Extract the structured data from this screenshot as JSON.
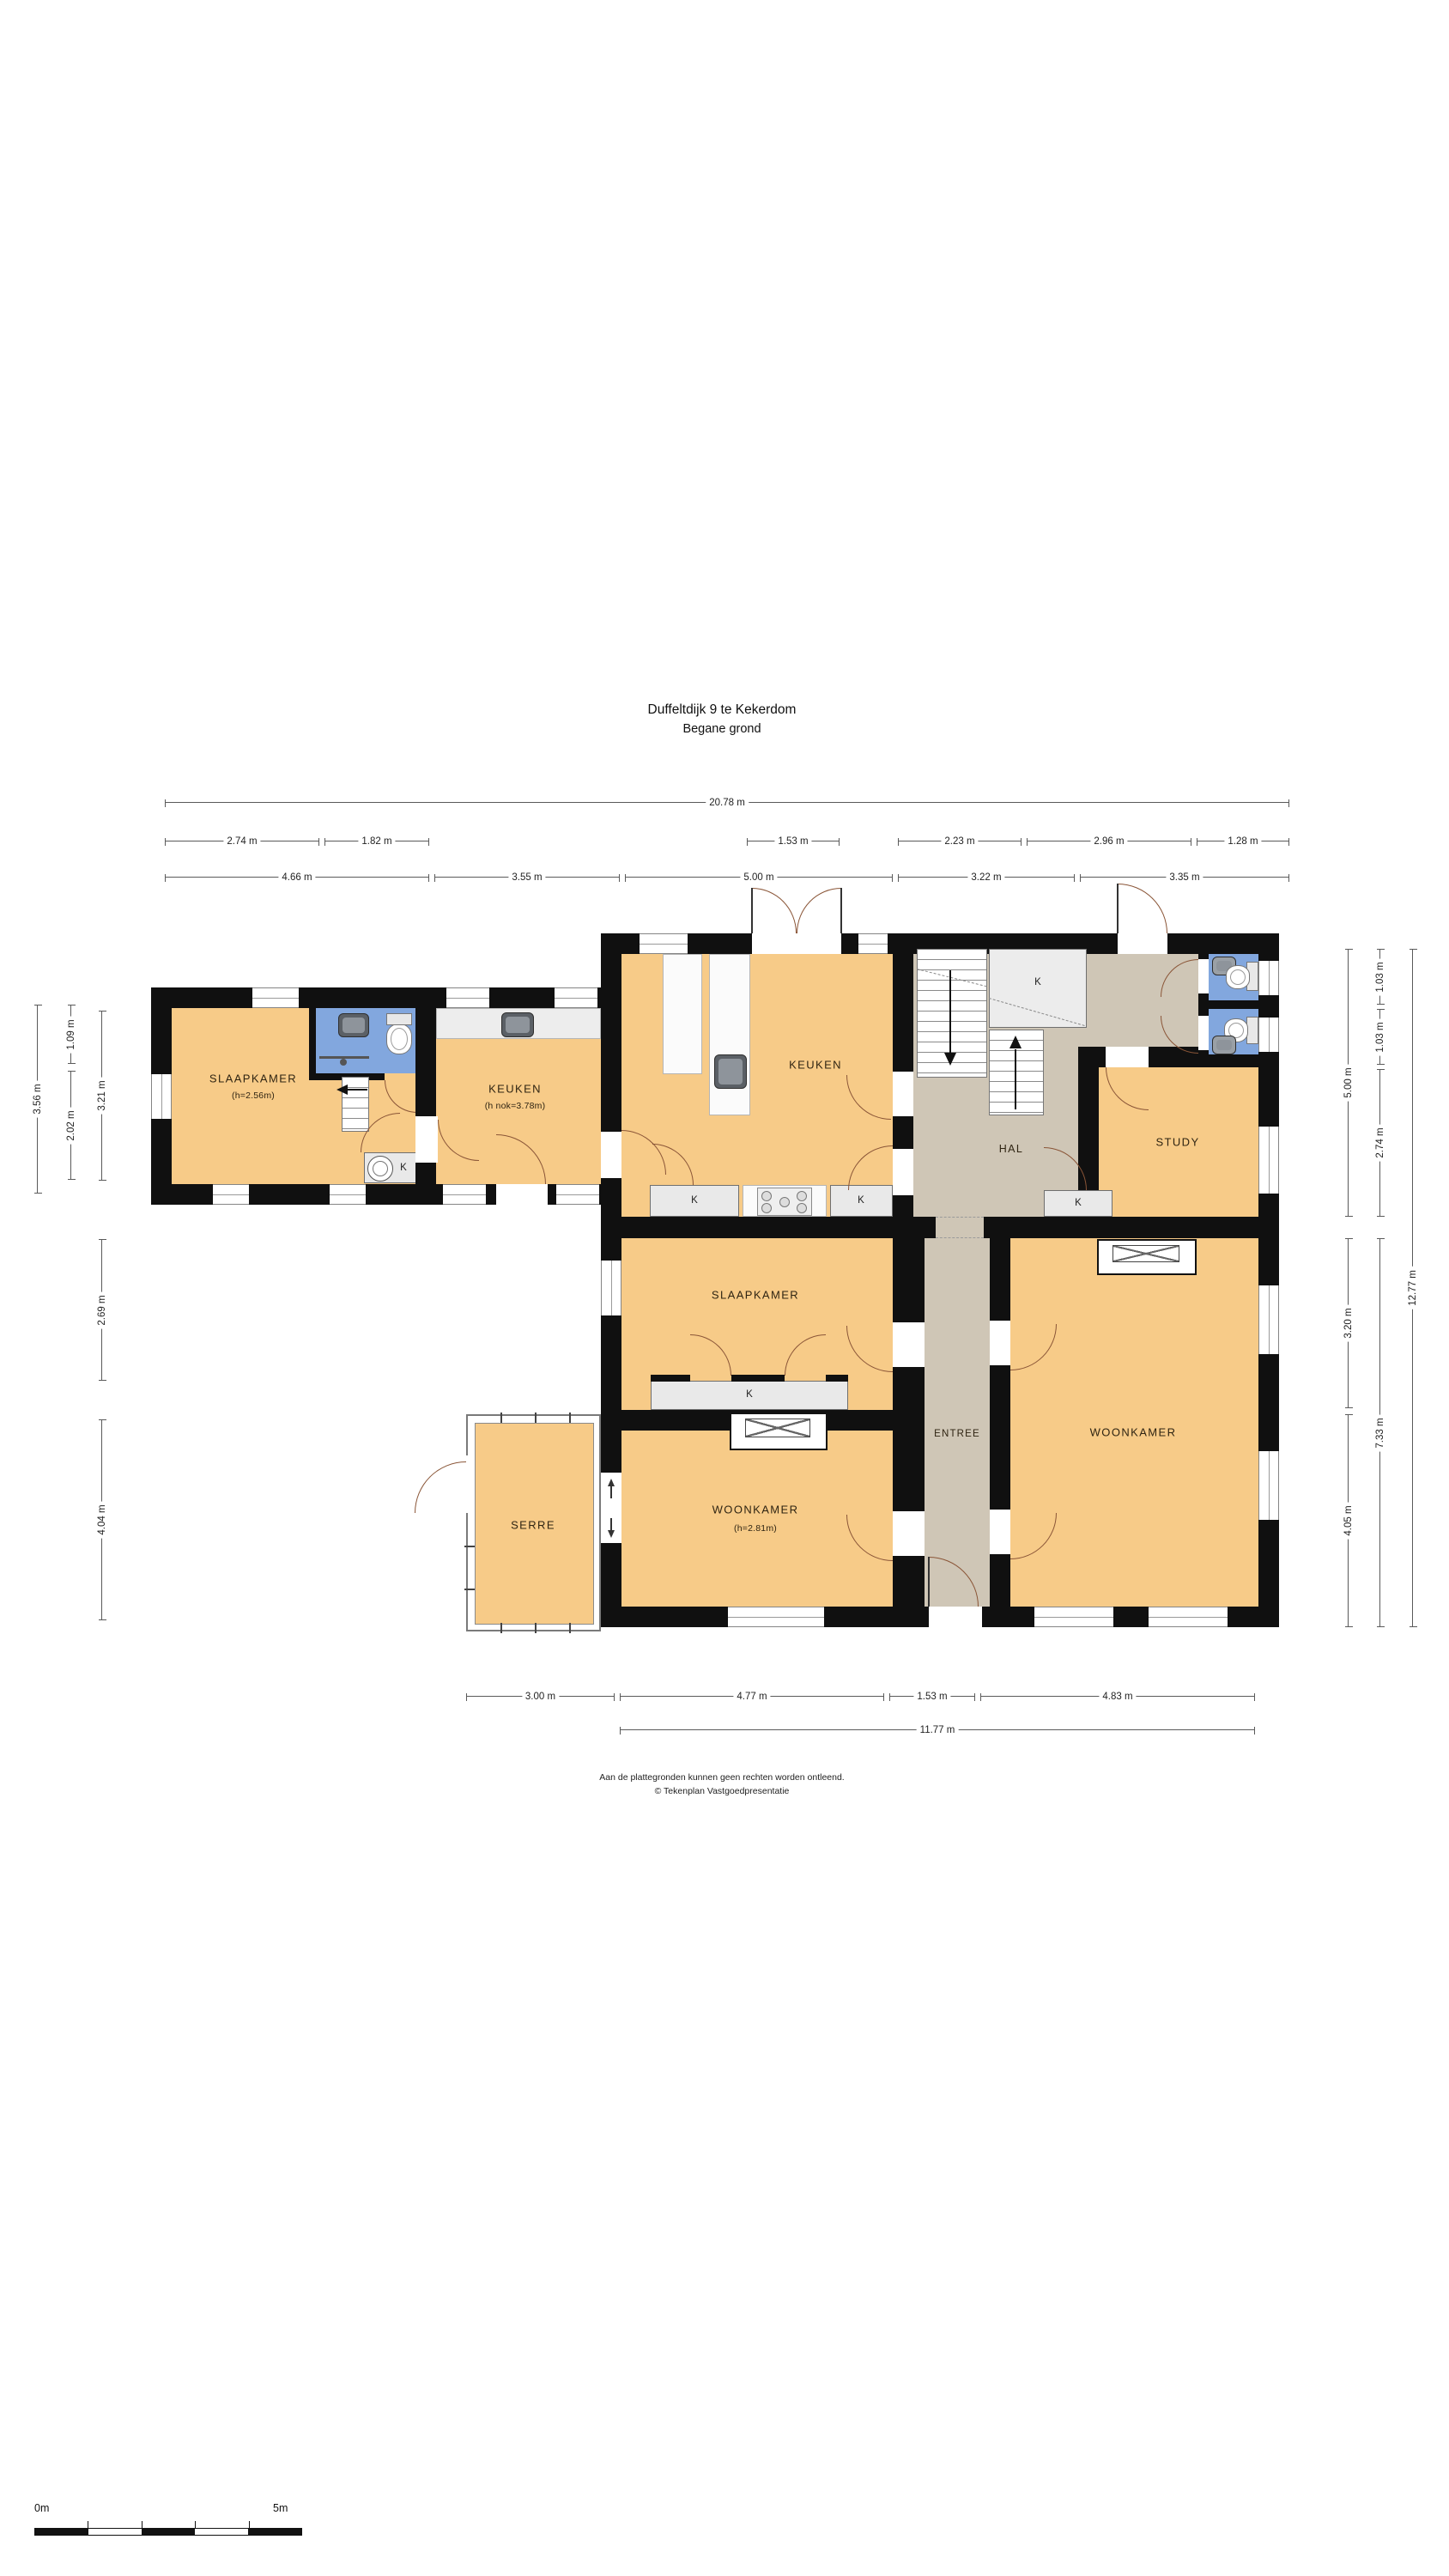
{
  "title": {
    "line1": "Duffeltdijk 9 te Kekerdom",
    "line2": "Begane grond"
  },
  "rooms": {
    "slaapkamer_west": {
      "name": "SLAAPKAMER",
      "note": "(h=2.56m)"
    },
    "keuken_aanbouw": {
      "name": "KEUKEN",
      "note": "(h nok=3.78m)"
    },
    "keuken": {
      "name": "KEUKEN"
    },
    "hal": {
      "name": "HAL"
    },
    "study": {
      "name": "STUDY"
    },
    "slaapkamer_mid": {
      "name": "SLAAPKAMER"
    },
    "entree": {
      "name": "ENTREE"
    },
    "woonkamer_mid": {
      "name": "WOONKAMER",
      "note": "(h=2.81m)"
    },
    "woonkamer_east": {
      "name": "WOONKAMER"
    },
    "serre": {
      "name": "SERRE"
    }
  },
  "labels": {
    "k": "K"
  },
  "dims": {
    "w_total": "20.78 m",
    "t1": "2.74 m",
    "t2": "1.82 m",
    "t3": "1.53 m",
    "t4": "2.23 m",
    "t5": "2.96 m",
    "t6": "1.28 m",
    "s1": "4.66 m",
    "s2": "3.55 m",
    "s3": "5.00 m",
    "s4": "3.22 m",
    "s5": "3.35 m",
    "l1": "3.56 m",
    "l2": "1.09 m",
    "l3": "2.02 m",
    "l4": "3.21 m",
    "l5": "2.69 m",
    "l6": "4.04 m",
    "r1": "5.00 m",
    "r2": "1.03 m",
    "r3": "1.03 m",
    "r4": "2.74 m",
    "r5": "12.77 m",
    "r6": "3.20 m",
    "r7": "7.33 m",
    "r8": "4.05 m",
    "b1": "3.00 m",
    "b2": "4.77 m",
    "b3": "1.53 m",
    "b4": "4.83 m",
    "b5": "11.77 m"
  },
  "footer": {
    "line1": "Aan de plattegronden kunnen geen rechten worden ontleend.",
    "line2": "© Tekenplan Vastgoedpresentatie"
  },
  "scalebar": {
    "start": "0m",
    "end": "5m"
  },
  "colors": {
    "room_fill": "#f7cb88",
    "hall_fill": "#cfc6b6",
    "bath_fill": "#82a7de",
    "wall": "#101010",
    "closet_fill": "#e9e9e9",
    "door_arc": "#8a5537"
  }
}
